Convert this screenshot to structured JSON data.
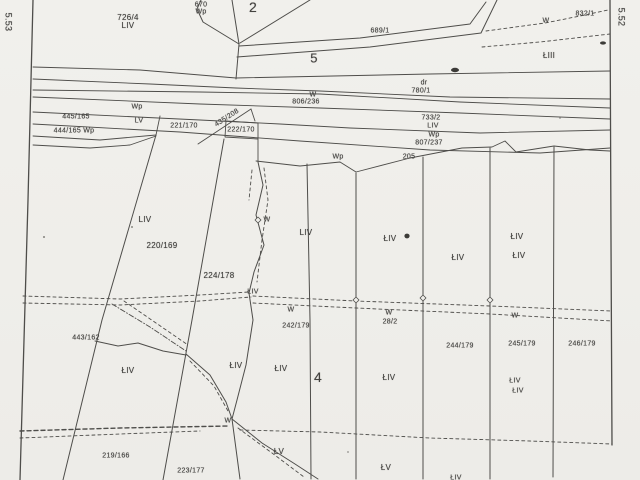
{
  "map": {
    "type": "scanned-cadastral-parcel-map",
    "colors": {
      "background": "#efeeea",
      "line": "#4e4d4a",
      "text": "#444340"
    },
    "labels": [
      {
        "text": "726/4",
        "x": 128,
        "y": 18,
        "kind": "parcel-number"
      },
      {
        "text": "LIV",
        "x": 128,
        "y": 26,
        "kind": "land-class"
      },
      {
        "text": "670",
        "x": 201,
        "y": 5,
        "size": 7,
        "kind": "parcel-number"
      },
      {
        "text": "Wp",
        "x": 201,
        "y": 12,
        "size": 7,
        "kind": "land-class"
      },
      {
        "text": "2",
        "x": 253,
        "y": 7,
        "size": 14,
        "kind": "block-number"
      },
      {
        "text": "689/1",
        "x": 380,
        "y": 31,
        "size": 7,
        "kind": "parcel-number"
      },
      {
        "text": "5",
        "x": 314,
        "y": 58,
        "size": 13,
        "kind": "block-number"
      },
      {
        "text": "W",
        "x": 546,
        "y": 21,
        "size": 7,
        "kind": "land-class"
      },
      {
        "text": "832/1",
        "x": 585,
        "y": 14,
        "size": 7,
        "kind": "parcel-number"
      },
      {
        "text": "ŁIII",
        "x": 549,
        "y": 56,
        "kind": "land-class"
      },
      {
        "text": "dr",
        "x": 424,
        "y": 83,
        "size": 7,
        "kind": "land-class"
      },
      {
        "text": "780/1",
        "x": 421,
        "y": 91,
        "size": 7,
        "kind": "parcel-number"
      },
      {
        "text": "W",
        "x": 313,
        "y": 95,
        "size": 7,
        "kind": "land-class"
      },
      {
        "text": "806/236",
        "x": 306,
        "y": 102,
        "size": 7,
        "kind": "parcel-number"
      },
      {
        "text": "Wp",
        "x": 137,
        "y": 107,
        "size": 7,
        "kind": "land-class"
      },
      {
        "text": "445/165",
        "x": 76,
        "y": 117,
        "size": 7,
        "kind": "parcel-number"
      },
      {
        "text": "LV",
        "x": 139,
        "y": 121,
        "size": 7,
        "kind": "land-class"
      },
      {
        "text": "444/165 Wp",
        "x": 74,
        "y": 131,
        "size": 7,
        "kind": "parcel-number"
      },
      {
        "text": "221/170",
        "x": 184,
        "y": 126,
        "size": 7,
        "kind": "parcel-number"
      },
      {
        "text": "222/170",
        "x": 241,
        "y": 130,
        "size": 7,
        "kind": "parcel-number"
      },
      {
        "text": "435/208",
        "x": 227,
        "y": 118,
        "size": 7,
        "rot": -33,
        "kind": "parcel-number"
      },
      {
        "text": "733/2",
        "x": 431,
        "y": 118,
        "size": 7,
        "kind": "parcel-number"
      },
      {
        "text": "LIV",
        "x": 433,
        "y": 126,
        "size": 7,
        "kind": "land-class"
      },
      {
        "text": "Wp",
        "x": 434,
        "y": 135,
        "size": 7,
        "kind": "land-class"
      },
      {
        "text": "807/237",
        "x": 429,
        "y": 143,
        "size": 7,
        "kind": "parcel-number"
      },
      {
        "text": "Wp",
        "x": 338,
        "y": 157,
        "size": 7,
        "kind": "land-class"
      },
      {
        "text": "205",
        "x": 409,
        "y": 157,
        "size": 7,
        "kind": "parcel-number"
      },
      {
        "text": "LIV",
        "x": 145,
        "y": 220,
        "kind": "land-class"
      },
      {
        "text": "220/169",
        "x": 162,
        "y": 246,
        "kind": "parcel-number"
      },
      {
        "text": "224/178",
        "x": 219,
        "y": 276,
        "kind": "parcel-number"
      },
      {
        "text": "W",
        "x": 267,
        "y": 220,
        "size": 7,
        "kind": "land-class"
      },
      {
        "text": "LIV",
        "x": 306,
        "y": 233,
        "kind": "land-class"
      },
      {
        "text": "ŁIV",
        "x": 390,
        "y": 239,
        "kind": "land-class"
      },
      {
        "text": "ŁIV",
        "x": 458,
        "y": 258,
        "kind": "land-class"
      },
      {
        "text": "ŁIV",
        "x": 517,
        "y": 237,
        "kind": "land-class"
      },
      {
        "text": "ŁIV",
        "x": 519,
        "y": 256,
        "kind": "land-class"
      },
      {
        "text": "ŁIV",
        "x": 253,
        "y": 292,
        "size": 7,
        "kind": "land-class"
      },
      {
        "text": "W",
        "x": 291,
        "y": 310,
        "size": 7,
        "kind": "land-class"
      },
      {
        "text": "W",
        "x": 389,
        "y": 313,
        "size": 7,
        "kind": "land-class"
      },
      {
        "text": "W",
        "x": 515,
        "y": 316,
        "size": 7,
        "kind": "land-class"
      },
      {
        "text": "28/2",
        "x": 390,
        "y": 322,
        "size": 7,
        "kind": "parcel-number"
      },
      {
        "text": "242/179",
        "x": 296,
        "y": 326,
        "size": 7,
        "kind": "parcel-number"
      },
      {
        "text": "443/162",
        "x": 86,
        "y": 338,
        "size": 7,
        "kind": "parcel-number"
      },
      {
        "text": "ŁIV",
        "x": 128,
        "y": 371,
        "kind": "land-class"
      },
      {
        "text": "ŁIV",
        "x": 236,
        "y": 366,
        "kind": "land-class"
      },
      {
        "text": "ŁIV",
        "x": 281,
        "y": 369,
        "kind": "land-class"
      },
      {
        "text": "4",
        "x": 318,
        "y": 377,
        "size": 14,
        "kind": "block-number"
      },
      {
        "text": "ŁIV",
        "x": 389,
        "y": 378,
        "kind": "land-class"
      },
      {
        "text": "244/179",
        "x": 460,
        "y": 346,
        "size": 7,
        "kind": "parcel-number"
      },
      {
        "text": "245/179",
        "x": 522,
        "y": 344,
        "size": 7,
        "kind": "parcel-number"
      },
      {
        "text": "246/179",
        "x": 582,
        "y": 344,
        "size": 7,
        "kind": "parcel-number"
      },
      {
        "text": "ŁIV",
        "x": 515,
        "y": 381,
        "size": 7,
        "kind": "land-class"
      },
      {
        "text": "ŁIV",
        "x": 518,
        "y": 391,
        "size": 7,
        "kind": "land-class"
      },
      {
        "text": "W",
        "x": 228,
        "y": 421,
        "size": 7,
        "kind": "land-class"
      },
      {
        "text": "219/166",
        "x": 116,
        "y": 456,
        "size": 7,
        "kind": "parcel-number"
      },
      {
        "text": "223/177",
        "x": 191,
        "y": 471,
        "size": 7,
        "kind": "parcel-number"
      },
      {
        "text": "ŁV",
        "x": 279,
        "y": 452,
        "kind": "land-class"
      },
      {
        "text": "ŁV",
        "x": 386,
        "y": 468,
        "kind": "land-class"
      },
      {
        "text": "ŁIV",
        "x": 456,
        "y": 478,
        "size": 7,
        "kind": "land-class"
      },
      {
        "text": "5.53",
        "x": 8,
        "y": 22,
        "size": 9,
        "rot": 90,
        "kind": "sheet-coordinate"
      },
      {
        "text": "5.52",
        "x": 621,
        "y": 17,
        "size": 9,
        "rot": 90,
        "kind": "sheet-coordinate"
      }
    ]
  }
}
